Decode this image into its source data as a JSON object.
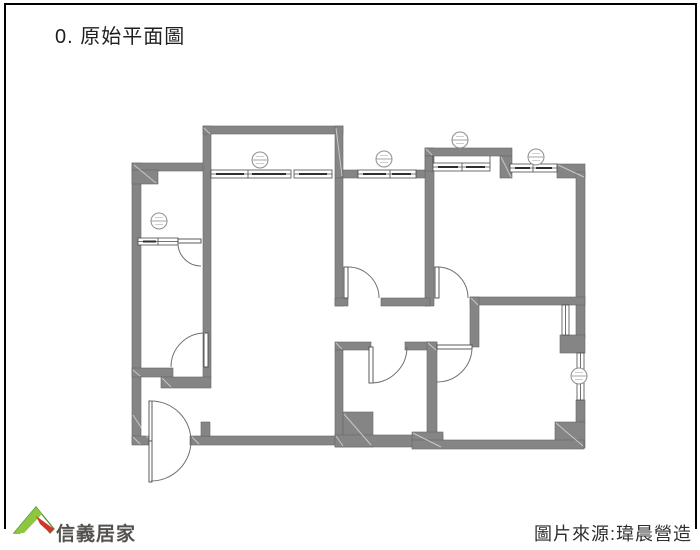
{
  "header": {
    "title": "0. 原始平面圖"
  },
  "footer": {
    "brand_name": "信義居家",
    "source_label": "圖片來源:瑋晨營造"
  },
  "floor_plan": {
    "label": "原始平面圖",
    "style": "grayscale architectural line drawing",
    "door_count": 7,
    "window_count": 7,
    "window_tag_count": 6
  },
  "colors": {
    "wall": "#858585",
    "line": "#4a4a4a",
    "arc": "#707070",
    "frame": "#000000",
    "title": "#1f1f1f",
    "footer": "#2f2f2f",
    "brand": "#55524e",
    "logo-green": "#8dc63f",
    "logo-dark-green": "#4c8b2b",
    "logo-red": "#d2342b"
  }
}
